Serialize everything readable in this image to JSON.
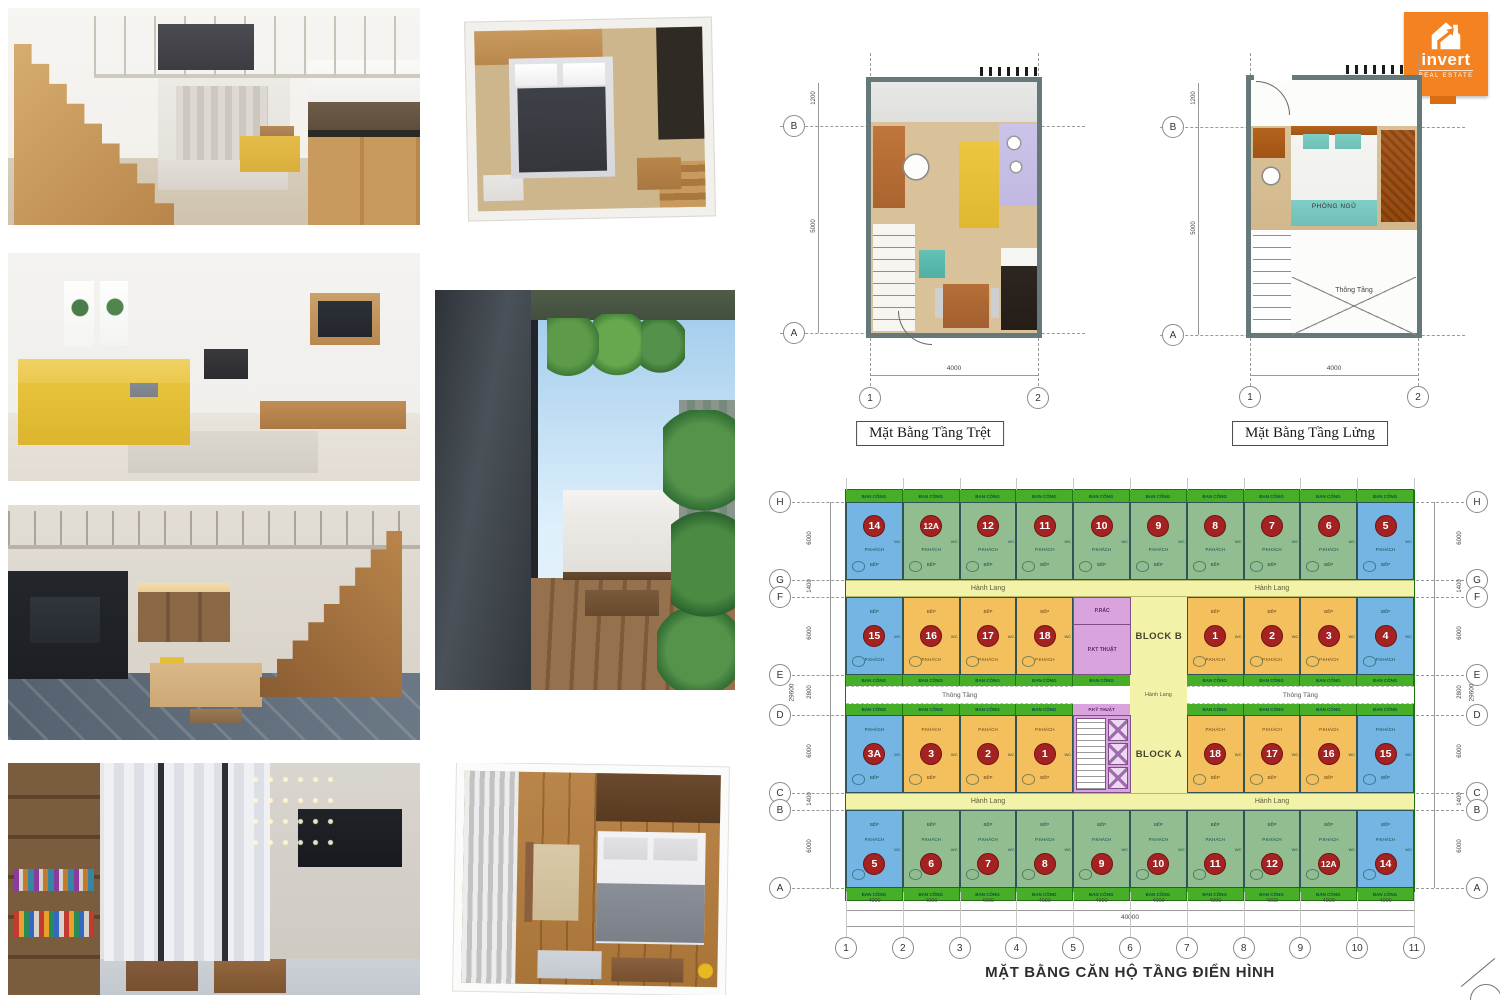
{
  "logo": {
    "brand": "invert",
    "tagline": "REAL ESTATE",
    "color": "#F58220"
  },
  "ground_plan": {
    "caption": "Mặt Bằng Tầng Trệt",
    "row_markers": [
      "B",
      "A"
    ],
    "col_markers": [
      "1",
      "2"
    ],
    "dim_left_top": "1200",
    "dim_left": "5000",
    "dim_bottom": "4000"
  },
  "mezzanine_plan": {
    "caption": "Mặt Bằng Tầng Lửng",
    "bedroom_label": "PHÒNG NGỦ",
    "void_label": "Thông Tầng",
    "row_markers": [
      "B",
      "A"
    ],
    "col_markers": [
      "1",
      "2"
    ],
    "dim_top": "4000",
    "dim_left_top": "1200",
    "dim_left": "5000",
    "dim_bottom": "4000"
  },
  "typical_plan": {
    "caption": "MẶT BẰNG CĂN HỘ TẦNG ĐIỂN HÌNH",
    "left_markers": [
      "H",
      "G",
      "F",
      "E",
      "D",
      "C",
      "B",
      "A"
    ],
    "right_markers": [
      "H",
      "G",
      "F",
      "E",
      "D",
      "C",
      "B",
      "A"
    ],
    "bottom_markers": [
      "1",
      "2",
      "3",
      "4",
      "5",
      "6",
      "7",
      "8",
      "9",
      "10",
      "11"
    ],
    "side_dims": [
      "6000",
      "1400",
      "6000",
      "2800",
      "6000",
      "1400",
      "6000"
    ],
    "side_total": "29600",
    "bottom_dims": [
      "4000",
      "4000",
      "4000",
      "4000",
      "4000",
      "4000",
      "4000",
      "4000",
      "4000",
      "4000"
    ],
    "bottom_total": "40000",
    "labels": {
      "balcony": "BAN CÔNG",
      "corridor": "Hành Lang",
      "void": "Thông Tầng",
      "living": "P.KHÁCH",
      "kitchen": "BẾP",
      "wc": "WC",
      "block_a": "BLOCK A",
      "block_b": "BLOCK B",
      "trash": "P.RÁC",
      "tech": "P.KT THUẬT",
      "tech2": "P.KỸ THUẬT"
    },
    "rows": {
      "row1": [
        {
          "no": "14",
          "c": "blue"
        },
        {
          "no": "12A",
          "c": "green"
        },
        {
          "no": "12",
          "c": "green"
        },
        {
          "no": "11",
          "c": "green"
        },
        {
          "no": "10",
          "c": "green"
        },
        {
          "no": "9",
          "c": "green"
        },
        {
          "no": "8",
          "c": "green"
        },
        {
          "no": "7",
          "c": "green"
        },
        {
          "no": "6",
          "c": "green"
        },
        {
          "no": "5",
          "c": "blue"
        }
      ],
      "row2_left": [
        {
          "no": "15",
          "c": "blue"
        },
        {
          "no": "16",
          "c": "orange"
        },
        {
          "no": "17",
          "c": "orange"
        },
        {
          "no": "18",
          "c": "orange"
        }
      ],
      "row2_right": [
        {
          "no": "1",
          "c": "orange"
        },
        {
          "no": "2",
          "c": "orange"
        },
        {
          "no": "3",
          "c": "orange"
        },
        {
          "no": "4",
          "c": "blue"
        }
      ],
      "row3_left": [
        {
          "no": "3A",
          "c": "blue"
        },
        {
          "no": "3",
          "c": "orange"
        },
        {
          "no": "2",
          "c": "orange"
        },
        {
          "no": "1",
          "c": "orange"
        }
      ],
      "row3_right": [
        {
          "no": "18",
          "c": "orange"
        },
        {
          "no": "17",
          "c": "orange"
        },
        {
          "no": "16",
          "c": "orange"
        },
        {
          "no": "15",
          "c": "blue"
        }
      ],
      "row4": [
        {
          "no": "5",
          "c": "blue"
        },
        {
          "no": "6",
          "c": "green"
        },
        {
          "no": "7",
          "c": "green"
        },
        {
          "no": "8",
          "c": "green"
        },
        {
          "no": "9",
          "c": "green"
        },
        {
          "no": "10",
          "c": "green"
        },
        {
          "no": "11",
          "c": "green"
        },
        {
          "no": "12",
          "c": "green"
        },
        {
          "no": "12A",
          "c": "green"
        },
        {
          "no": "14",
          "c": "blue"
        }
      ]
    },
    "colors": {
      "unit_blue": "#74B5E4",
      "unit_green": "#92BD90",
      "unit_orange": "#F4C05E",
      "core_pink": "#D9A3DD",
      "balcony_green": "#46AF27",
      "corridor_yellow": "#F2F2A8",
      "badge_red": "#A42222"
    }
  }
}
